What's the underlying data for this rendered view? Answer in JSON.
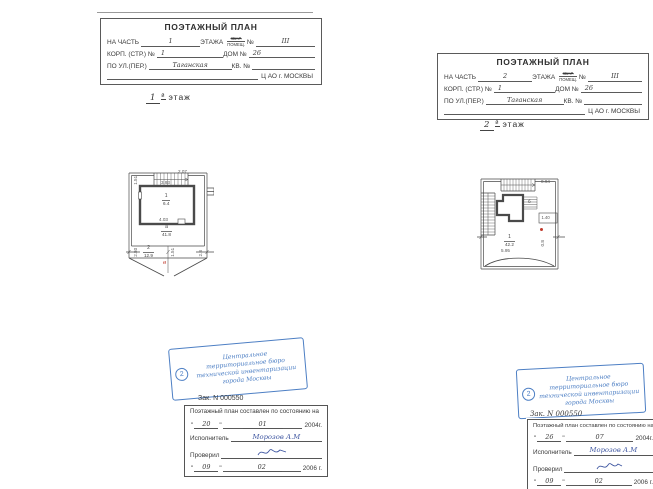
{
  "sheet1": {
    "header": {
      "title": "ПОЭТАЖНЫЙ ПЛАН",
      "row1": {
        "l1": "НА ЧАСТЬ",
        "v1": "1",
        "l2": "ЭТАЖА",
        "crossed": "КВАР.",
        "under": "ПОМЕЩ.",
        "l3": "№",
        "v2": "III"
      },
      "row2": {
        "l1": "КОРП. (СТР.) №",
        "v1": "1",
        "l2": "ДОМ №",
        "v2": "26"
      },
      "row3": {
        "l1": "ПО УЛ.(ПЕР.)",
        "v1": "Таганская",
        "l2": "КВ. №"
      },
      "row4": {
        "text": "Ц АО г. МОСКВЫ"
      }
    },
    "floor": {
      "num": "1",
      "suffix": "й",
      "word": "этаж"
    },
    "plan": {
      "dim_top": "2.07",
      "dim_stair": "1.51",
      "room_top": "3.93",
      "room_num": "1",
      "room_area": "6.4",
      "room_bottom": "4.03",
      "hall_num": "а",
      "hall_area": "41.8",
      "band_num": "2",
      "band_area": "12.9",
      "dim_b_left": "2.80",
      "dim_b_mid": "1.51",
      "dim_b_right": "2.8",
      "red_mark": "в"
    },
    "stamp": {
      "num": "2",
      "l1": "Центральное",
      "l2": "территориальное бюро",
      "l3": "технической инвентаризации",
      "l4": "города Москвы"
    },
    "order": "Зак. N 000550",
    "table": {
      "caption": "Поэтажный план составлен по состоянию на",
      "q": "\"",
      "d1": "20",
      "m1": "01",
      "y1": "2004г.",
      "executor_label": "Исполнитель",
      "executor": "Морозов А.М",
      "checker_label": "Проверил",
      "d2": "09",
      "m2": "02",
      "y2": "2006 г."
    }
  },
  "sheet2": {
    "header": {
      "title": "ПОЭТАЖНЫЙ ПЛАН",
      "row1": {
        "l1": "НА ЧАСТЬ",
        "v1": "2",
        "l2": "ЭТАЖА",
        "crossed": "КВАР.",
        "under": "ПОМЕЩ.",
        "l3": "№",
        "v2": "III"
      },
      "row2": {
        "l1": "КОРП. (СТР.) №",
        "v1": "1",
        "l2": "ДОМ №",
        "v2": "26"
      },
      "row3": {
        "l1": "ПО УЛ.(ПЕР.)",
        "v1": "Таганская",
        "l2": "КВ. №"
      },
      "row4": {
        "text": "Ц АО г. МОСКВЫ"
      }
    },
    "floor": {
      "num": "2",
      "suffix": "й",
      "word": "этаж"
    },
    "plan": {
      "dim_top": "0.94",
      "stair_room": "б",
      "box_dim": "1.40",
      "hall_num": "1",
      "hall_area": "42.2",
      "hall_width": "5.95",
      "dim_side": "0.8"
    },
    "stamp": {
      "num": "2",
      "l1": "Центральное",
      "l2": "территориальное бюро",
      "l3": "технической инвентаризации",
      "l4": "города Москвы"
    },
    "order": "Зак. N 000550",
    "table": {
      "caption": "Поэтажный план составлен по состоянию на",
      "q": "\"",
      "d1": "26",
      "m1": "07",
      "y1": "2004г.",
      "executor_label": "Исполнитель",
      "executor": "Морозов А.М",
      "checker_label": "Проверил",
      "d2": "09",
      "m2": "02",
      "y2": "2006 г."
    }
  }
}
